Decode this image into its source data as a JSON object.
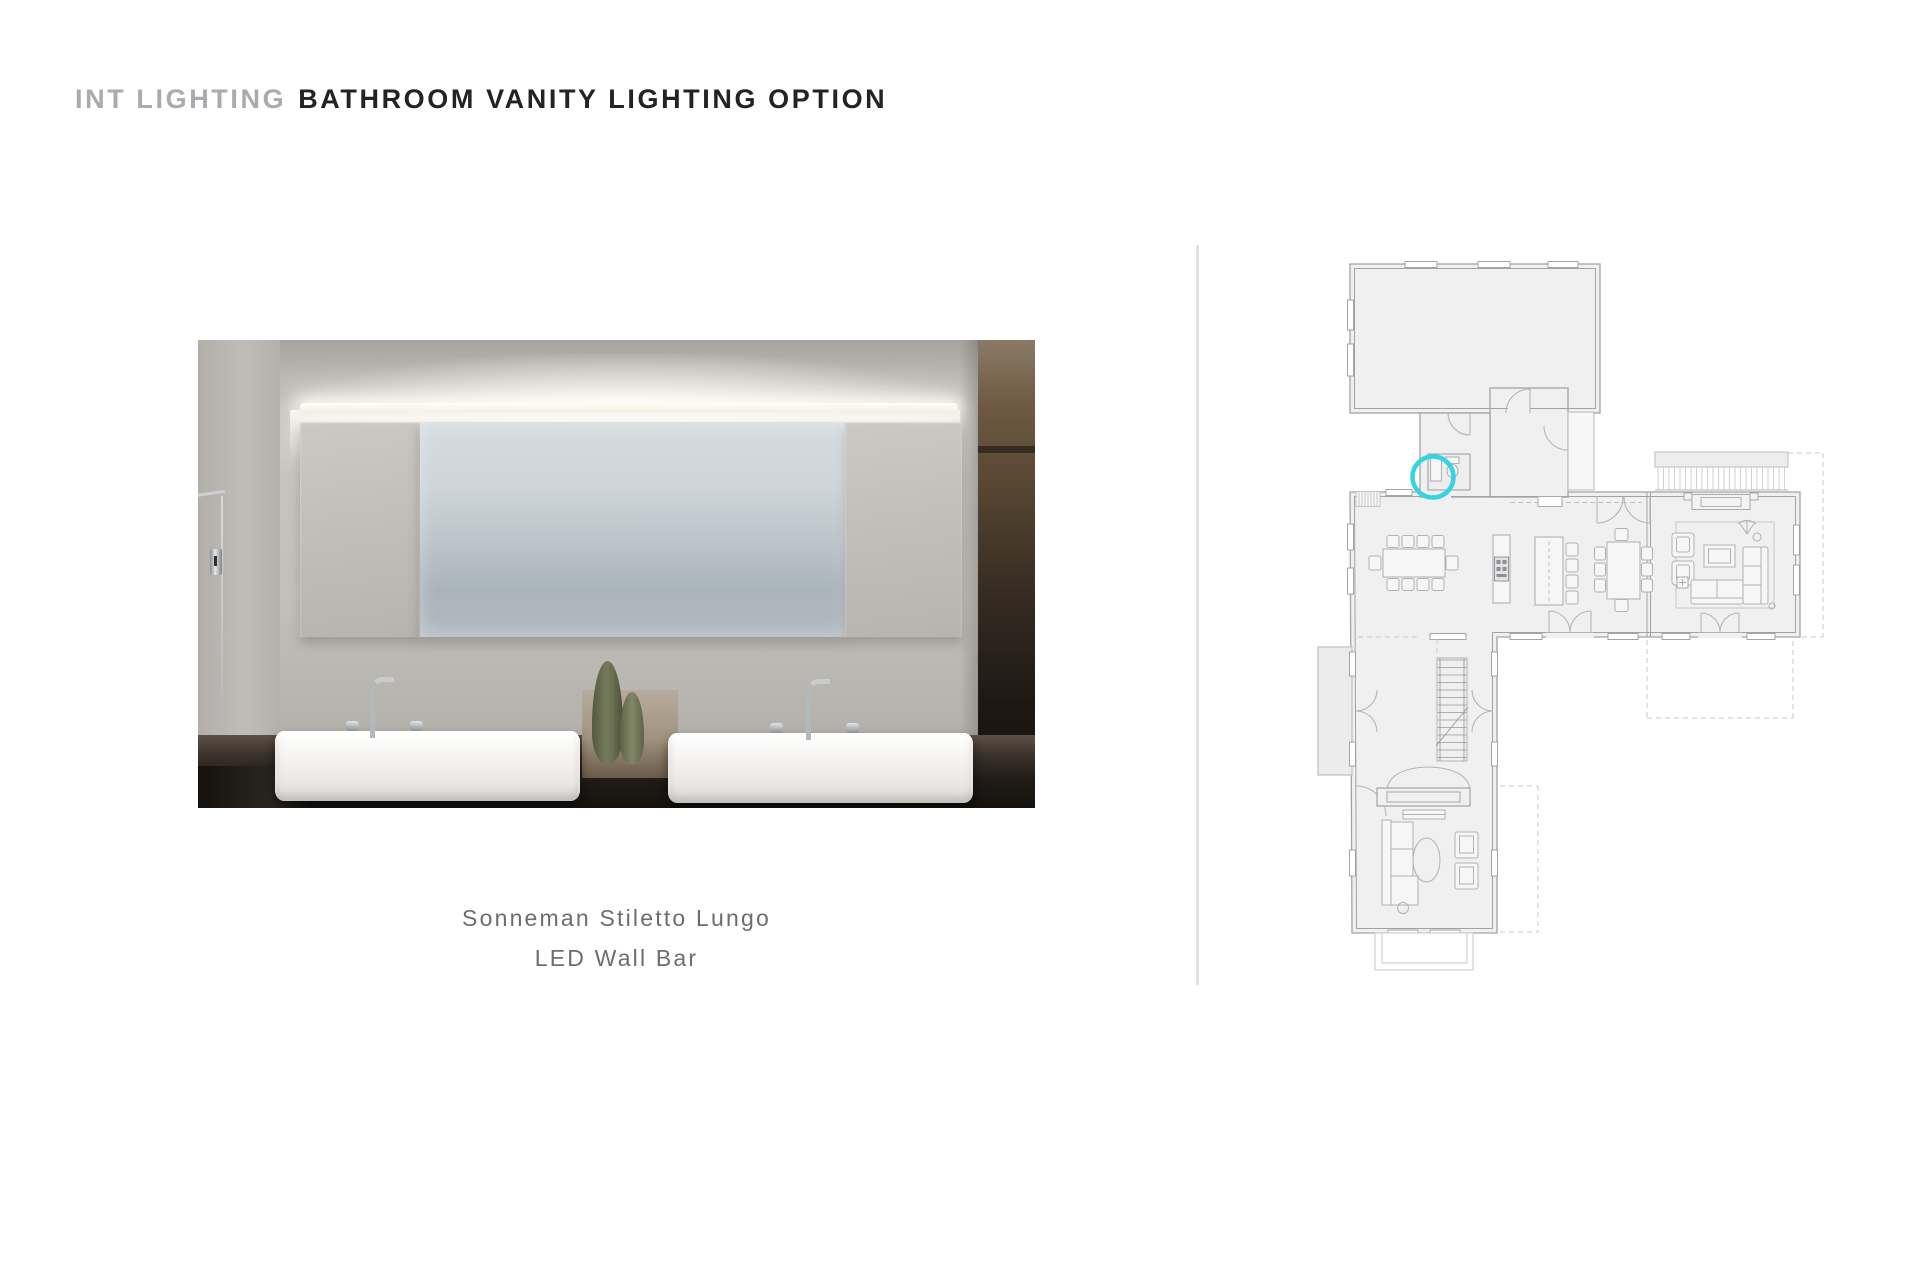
{
  "header": {
    "prefix": "INT LIGHTING",
    "title": "BATHROOM VANITY LIGHTING OPTION"
  },
  "caption": {
    "line1": "Sonneman Stiletto Lungo",
    "line2": "LED Wall Bar"
  },
  "colors": {
    "header_prefix": "#a9abae",
    "header_title": "#212325",
    "caption_text": "#6c6d70",
    "divider": "#e3e3e5",
    "plan_fill": "#f0f0f1",
    "plan_wall": "#a2a3a6",
    "location_marker_accent": "#35d3e3"
  },
  "photo": {
    "subject": "bathroom-vanity-rendering",
    "elements": [
      "led-wall-bar-light",
      "frosted-mirror",
      "marble-panels",
      "left-vessel-sink",
      "right-vessel-sink",
      "chrome-faucets",
      "green-vases",
      "glass-shower-door",
      "dark-stone-counter"
    ]
  },
  "floorplan": {
    "marker": "vanity-lighting-location",
    "rooms": [
      "garage",
      "entry-hall",
      "mudroom",
      "powder-room",
      "dining-area",
      "kitchen",
      "breakfast-area",
      "living-room",
      "stair-hall",
      "sitting-room",
      "deck",
      "front-porch"
    ]
  }
}
